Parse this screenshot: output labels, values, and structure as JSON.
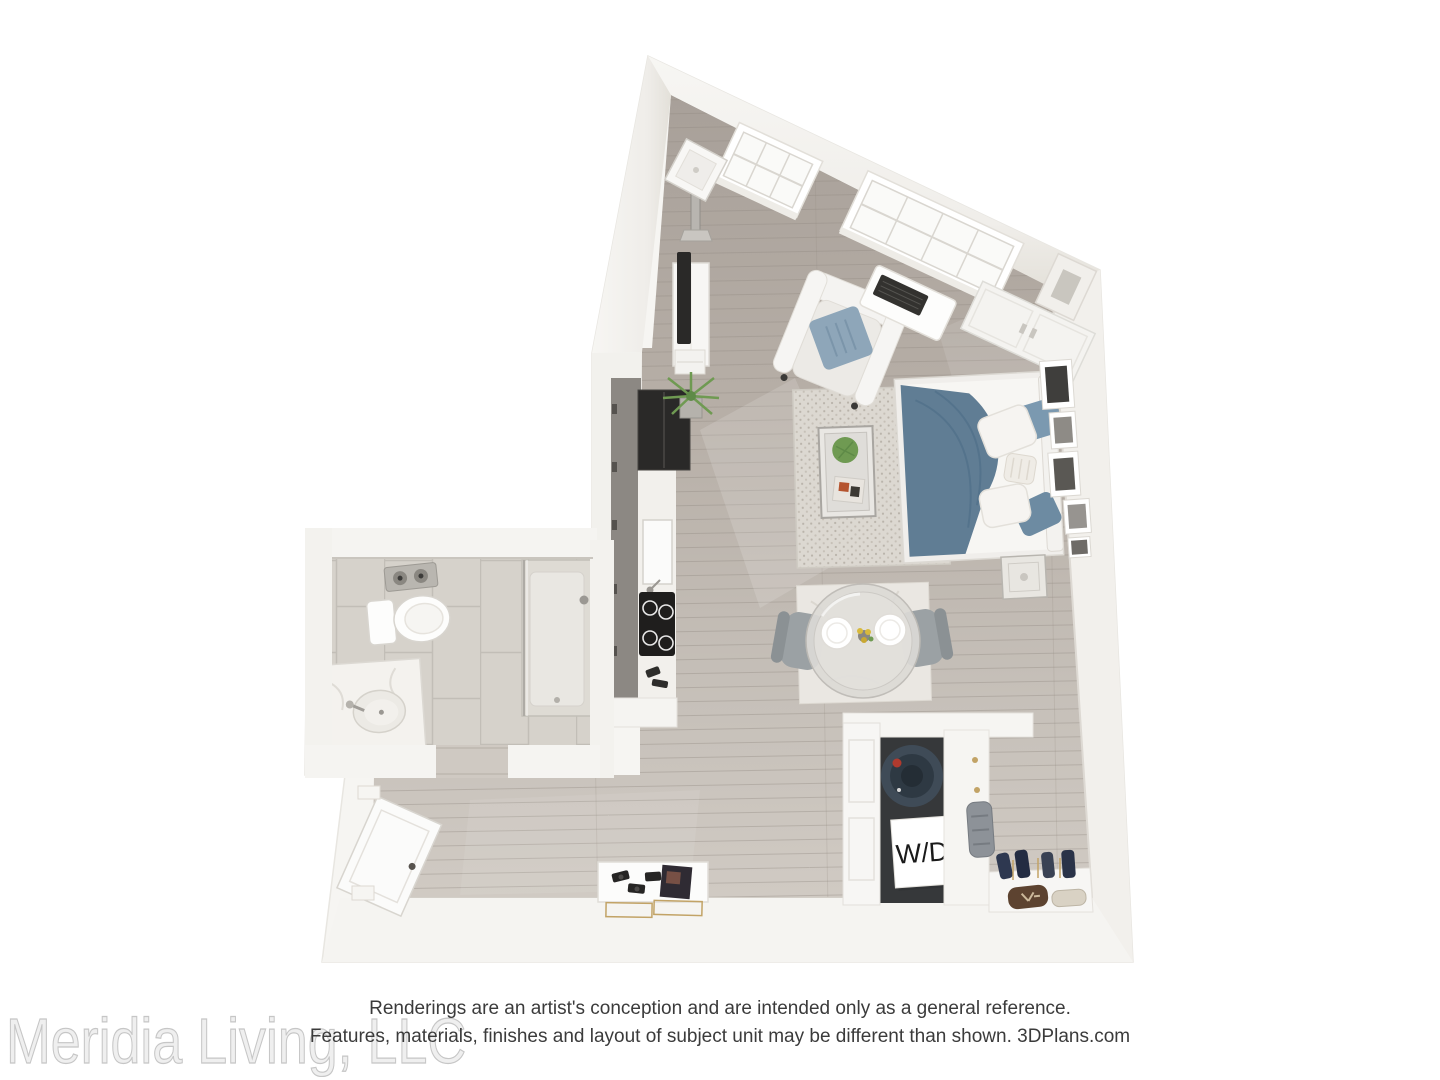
{
  "branding": {
    "watermark": "Meridia Living, LLC"
  },
  "disclaimer": {
    "line1": "Renderings are an artist's conception and are intended only as a general reference.",
    "line2": "Features, materials, finishes and layout of subject unit may be different than shown. 3DPlans.com"
  },
  "labels": {
    "washer_dryer": "W/D"
  },
  "palette": {
    "background": "#ffffff",
    "wall": "#f4f2ee",
    "wall_shade": "#e7e4dd",
    "wall_edge": "#d9d6d0",
    "floor_wood_dark": "#a9a19a",
    "floor_wood": "#b7afa7",
    "floor_wood_light": "#cfc9c2",
    "floor_tile": "#d6d2cb",
    "grout": "#c3bfb8",
    "rug": "#dcd8d1",
    "rug_dot": "#b9b3aa",
    "bed_blanket": "#607d94",
    "pillow_blue": "#7b99b0",
    "pillow_blue_dark": "#6d8ba2",
    "armchair_pillow": "#8ea6b9",
    "appliance_dark": "#2a2928",
    "cabinet_gray": "#8c8883",
    "washer_navy": "#3f4b57",
    "washer_ring": "#2e3943",
    "washer_dot_red": "#b03a2e",
    "marble": "#f2f0ec",
    "chair_gray": "#9ba1a4",
    "plant_green": "#6f9a52",
    "accent_gold": "#c2a366",
    "flower_yellow": "#d8b93c",
    "magazine_orange": "#b5542f",
    "text_dark": "#3b3b3b",
    "watermark_gray": "#c9c9c9",
    "label_black": "#1a1a1a"
  }
}
